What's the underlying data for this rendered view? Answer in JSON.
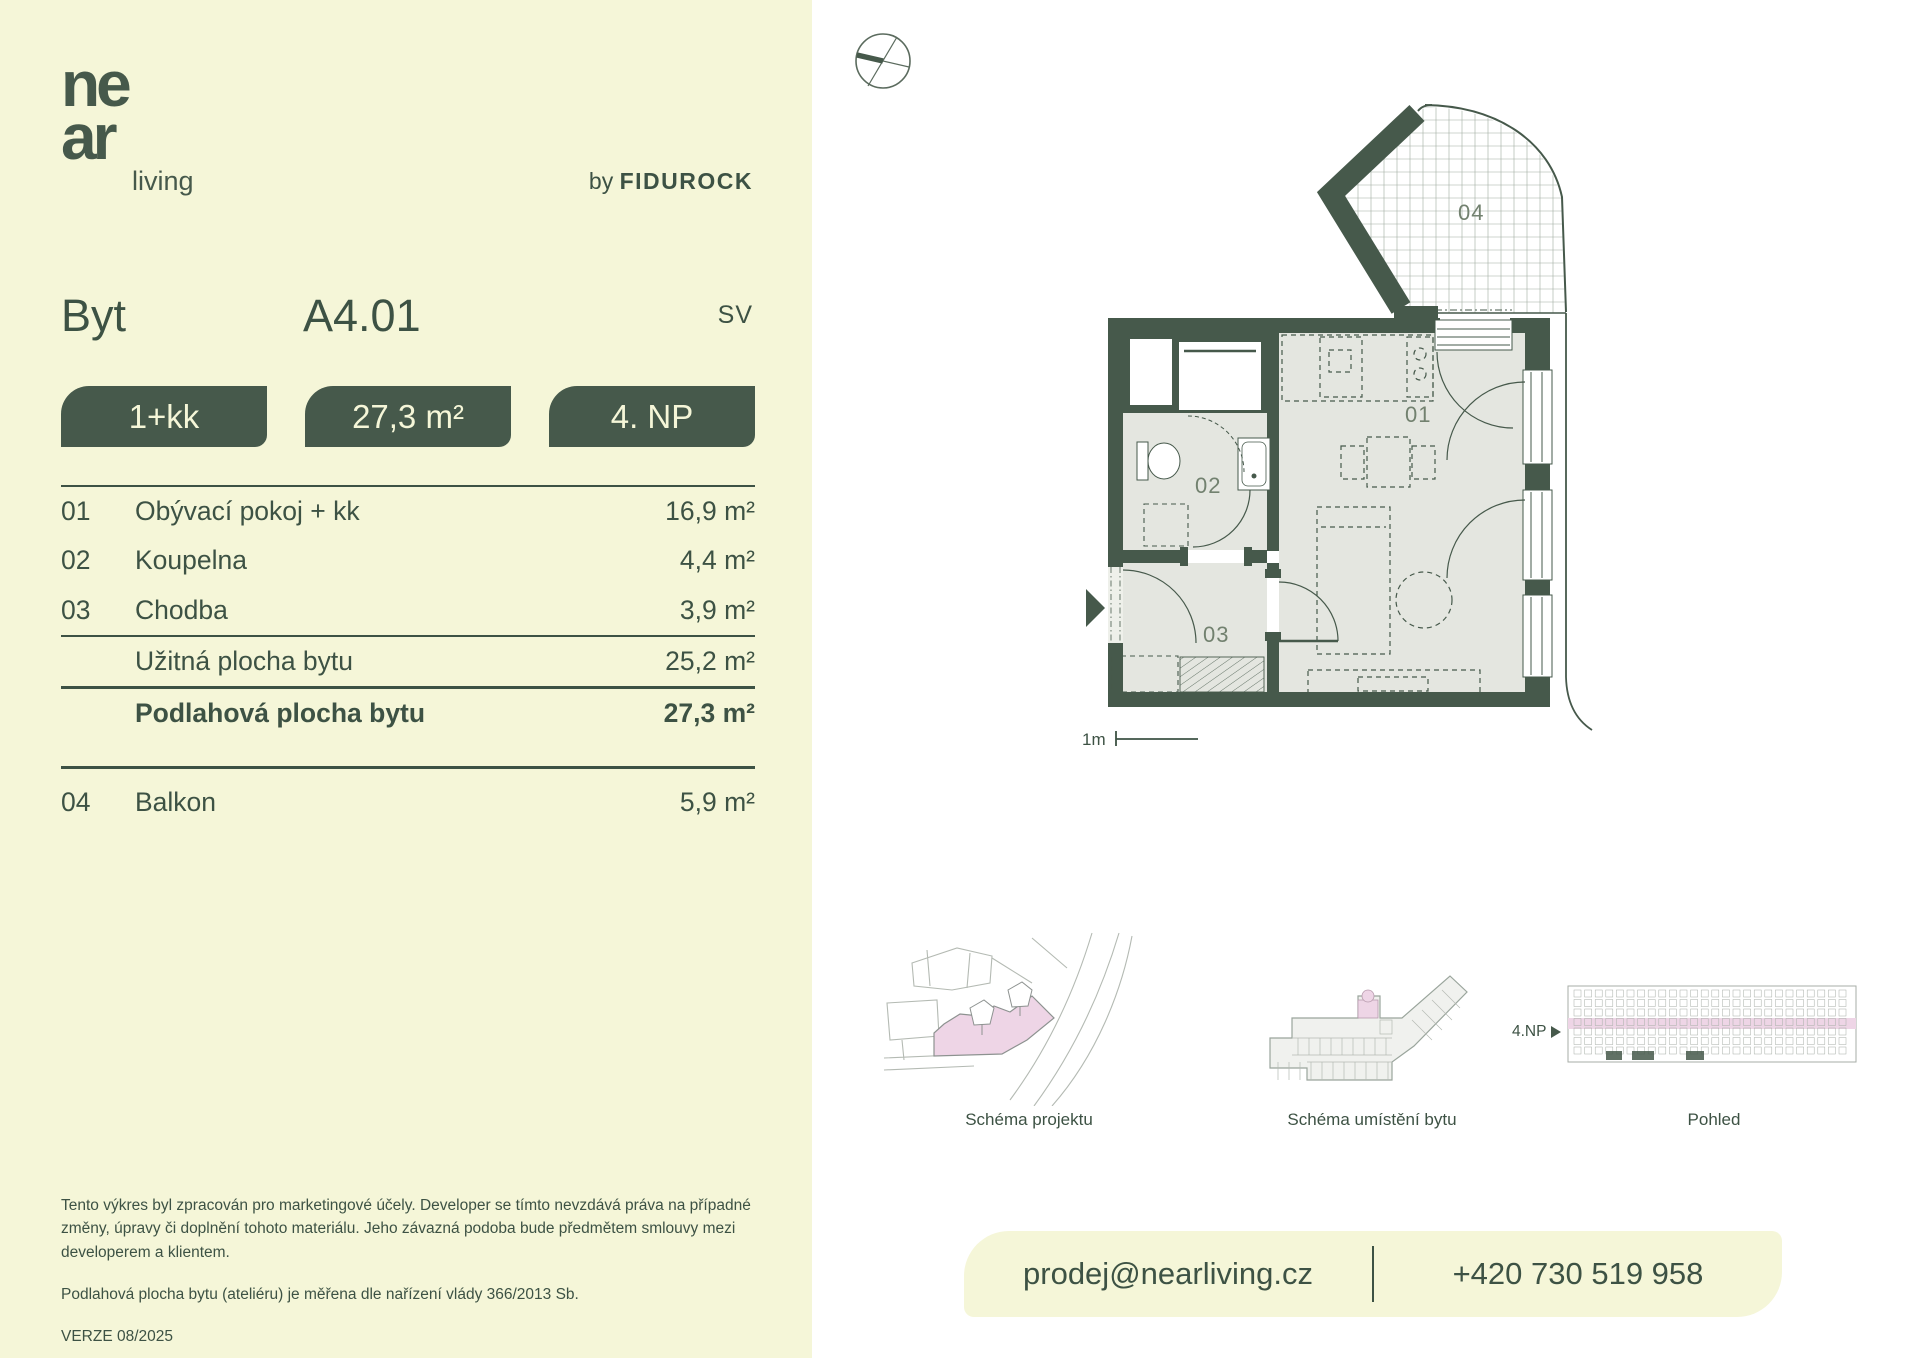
{
  "brand": {
    "logo_line1": "ne",
    "logo_line2": "ar",
    "logo_sub": "living",
    "by_prefix": "by",
    "by_name": "FIDUROCK"
  },
  "header": {
    "unit_type_label": "Byt",
    "unit_id": "A4.01",
    "orientation": "SV"
  },
  "badges": [
    {
      "label": "1+kk"
    },
    {
      "label": "27,3 m²"
    },
    {
      "label": "4. NP"
    }
  ],
  "rooms": [
    {
      "num": "01",
      "name": "Obývací pokoj + kk",
      "area": "16,9 m²"
    },
    {
      "num": "02",
      "name": "Koupelna",
      "area": "4,4 m²"
    },
    {
      "num": "03",
      "name": "Chodba",
      "area": "3,9 m²"
    }
  ],
  "totals": [
    {
      "name": "Užitná plocha bytu",
      "area": "25,2 m²"
    },
    {
      "name": "Podlahová plocha bytu",
      "area": "27,3 m²"
    }
  ],
  "exterior": [
    {
      "num": "04",
      "name": "Balkon",
      "area": "5,9 m²"
    }
  ],
  "floorplan": {
    "labels": {
      "room01": "01",
      "room02": "02",
      "room03": "03",
      "room04": "04"
    },
    "scale_label": "1m"
  },
  "schematics": [
    {
      "caption": "Schéma projektu"
    },
    {
      "caption": "Schéma umístění bytu"
    },
    {
      "caption": "Pohled",
      "floor_label": "4.NP"
    }
  ],
  "contact": {
    "email": "prodej@nearliving.cz",
    "phone": "+420 730 519 958"
  },
  "footer": {
    "disclaimer": "Tento výkres byl zpracován pro marketingové účely. Developer se tímto nevzdává práva na případné změny, úpravy či doplnění tohoto materiálu. Jeho závazná podoba bude předmětem smlouvy mezi developerem a klientem.",
    "measurement_note": "Podlahová plocha bytu (ateliéru) je měřena dle nařízení vlády 366/2013 Sb.",
    "version": "VERZE 08/2025"
  },
  "colors": {
    "green": "#46594b",
    "cream": "#f5f6d8",
    "room_fill": "#e4e6e0",
    "pink": "#eed5e6"
  }
}
